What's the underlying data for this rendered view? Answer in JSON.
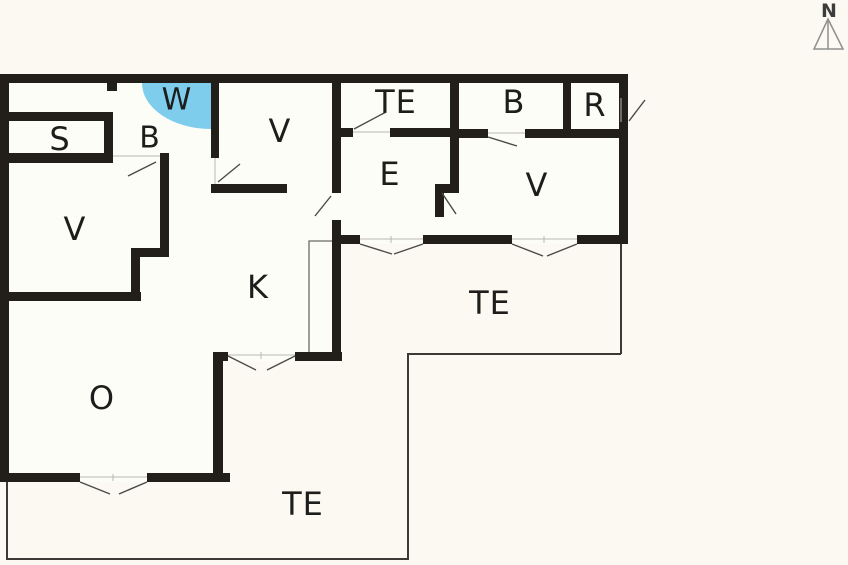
{
  "colors": {
    "background": "#fbf9f1",
    "interior": "#fdfdf8",
    "wall": "#221f1b",
    "shower": "#7fcdec",
    "doorline": "#4a4a48",
    "terraceline": "#3b3a36"
  },
  "compass": {
    "north_label": "N"
  },
  "rooms": {
    "s": {
      "label": "S"
    },
    "b_hall": {
      "label": "B"
    },
    "w": {
      "label": "W"
    },
    "v_left": {
      "label": "V"
    },
    "v_mid": {
      "label": "V"
    },
    "te_top": {
      "label": "TE"
    },
    "e": {
      "label": "E"
    },
    "b_right": {
      "label": "B"
    },
    "r": {
      "label": "R"
    },
    "v_right": {
      "label": "V"
    },
    "k": {
      "label": "K"
    },
    "te_right": {
      "label": "TE"
    },
    "o": {
      "label": "O"
    },
    "te_bottom": {
      "label": "TE"
    }
  }
}
